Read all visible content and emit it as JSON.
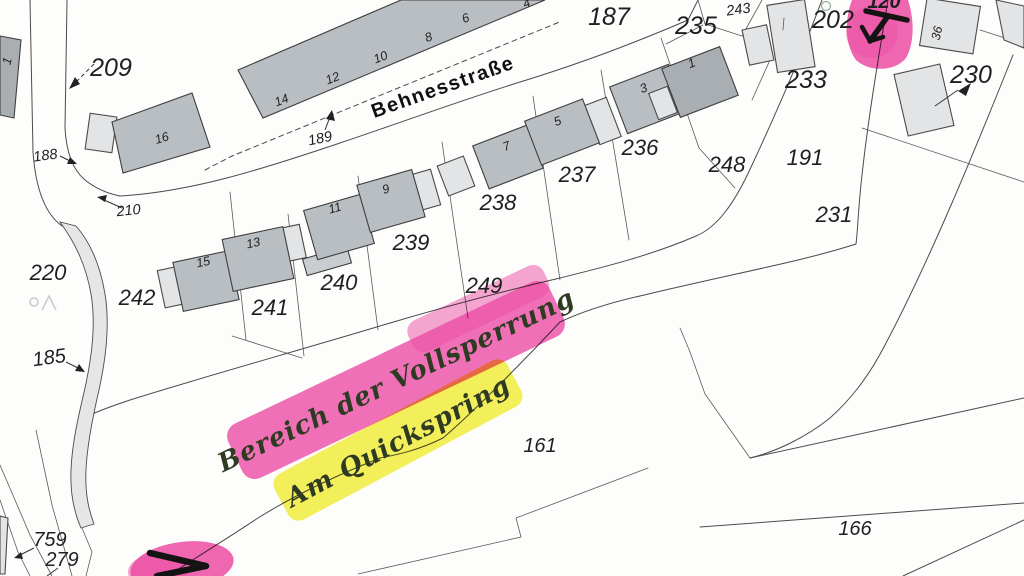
{
  "street": {
    "name": "Behnesstraße"
  },
  "handwriting": {
    "pink": "Bereich der Vollsperrung",
    "yellow": "Am Quickspring"
  },
  "parcels": {
    "120": "120",
    "161": "161",
    "166": "166",
    "185": "185",
    "187": "187",
    "188": "188",
    "189": "189",
    "191": "191",
    "202": "202",
    "209": "209",
    "210": "210",
    "220": "220",
    "230": "230",
    "231": "231",
    "233": "233",
    "235": "235",
    "236": "236",
    "237": "237",
    "238": "238",
    "239": "239",
    "240": "240",
    "241": "241",
    "242": "242",
    "243": "243",
    "248": "248",
    "249": "249",
    "279": "279",
    "759": "759"
  },
  "houses": {
    "1": "1",
    "3": "3",
    "4": "4",
    "5": "5",
    "6": "6",
    "7": "7",
    "8": "8",
    "9": "9",
    "10": "10",
    "11": "11",
    "12": "12",
    "13": "13",
    "14": "14",
    "15": "15",
    "16": "16",
    "36": "36"
  },
  "colors": {
    "highlight_pink": "#ee4da6",
    "highlight_yellow": "#f3ef3f",
    "marker_ink": "#2e3a22",
    "building_fill": "#b9bec3",
    "building_fill_light": "#e2e4e6",
    "line_color": "#4a4a4a"
  }
}
